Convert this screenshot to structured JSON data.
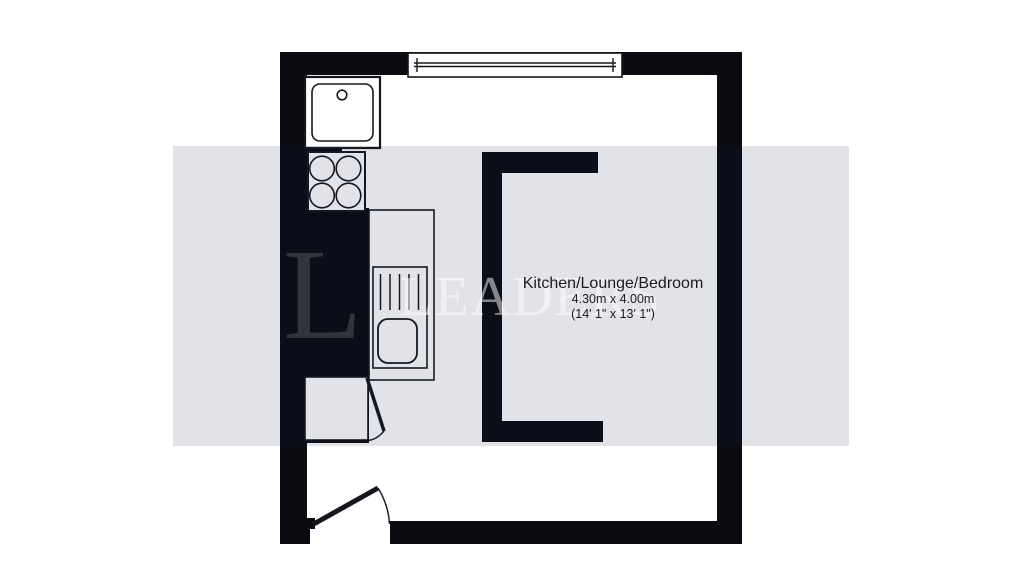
{
  "room": {
    "name": "Kitchen/Lounge/Bedroom",
    "size_metric": "4.30m x 4.00m",
    "size_imperial": "(14' 1\" x 13' 1\")"
  },
  "watermark": {
    "initial": "L",
    "text": "LEADERS"
  },
  "colors": {
    "wall": "#0b0c12",
    "line": "#16171d",
    "band": "#e2e3eb",
    "floor": "#ffffff",
    "label": "#1b1c22"
  },
  "fixtures": [
    "sink",
    "hob",
    "worktop-sink-unit",
    "window",
    "entrance-door",
    "cupboard-door",
    "wall-bracket"
  ]
}
